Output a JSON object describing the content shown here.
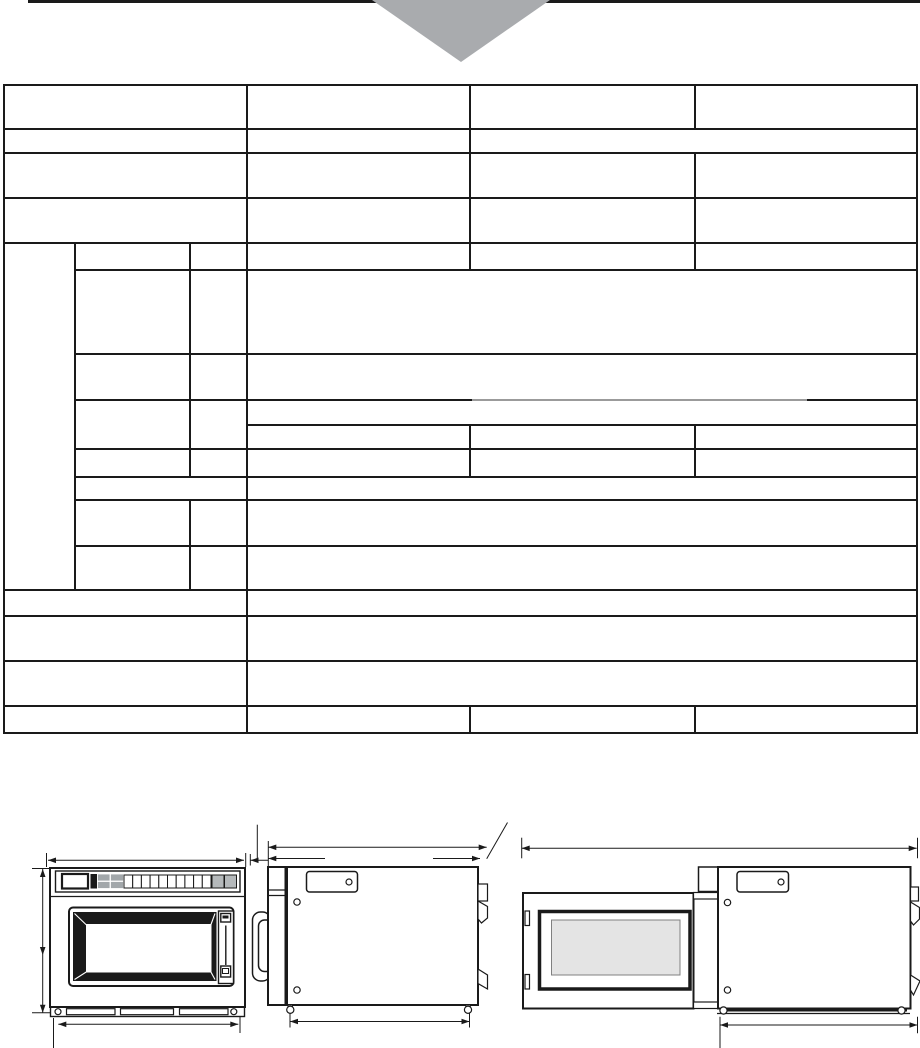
{
  "page": {
    "width_px": 920,
    "height_px": 1048,
    "background": "#ffffff"
  },
  "colors": {
    "line_black": "#1a1a1a",
    "triangle_gray": "#a9abae",
    "faded_gray": "#9b9b9b",
    "window_gray": "#e4e4e4",
    "key_gray": "#a2a7aa",
    "key_gray_light": "#b5b9bb"
  },
  "spec_table": {
    "row_count": 16,
    "column_count": 4,
    "cells_empty": true
  },
  "figures": {
    "count": 3,
    "items": [
      {
        "name": "front-view"
      },
      {
        "name": "side-view"
      },
      {
        "name": "side-view-door-open"
      }
    ]
  },
  "keypad": {
    "display_windows": 1,
    "gray_block_keys": 4,
    "white_keys": 10,
    "gray_end_keys": 2
  }
}
